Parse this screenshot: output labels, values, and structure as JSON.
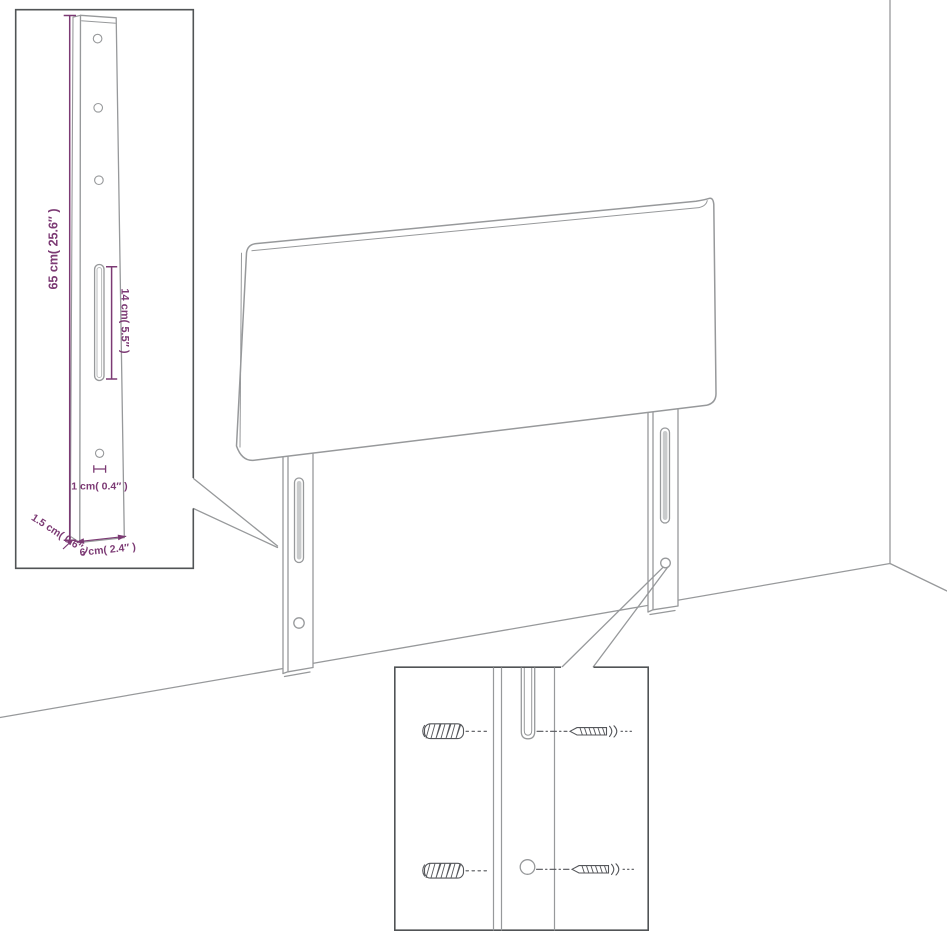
{
  "colors": {
    "background": "#ffffff",
    "drawing_line": "#97999b",
    "detail_line": "#54565a",
    "inset_border": "#515456",
    "dimension": "#7c3a74",
    "slot_fill": "#c9cbcc"
  },
  "labels": {
    "post_height": "65 cm( 25.6″ )",
    "slot_length": "14 cm( 5.5″ )",
    "hole_diameter": "1 cm( 0.4″ )",
    "post_thickness": "1.5 cm( 0.6″ )",
    "post_width": "6 cm( 2.4″ )"
  }
}
